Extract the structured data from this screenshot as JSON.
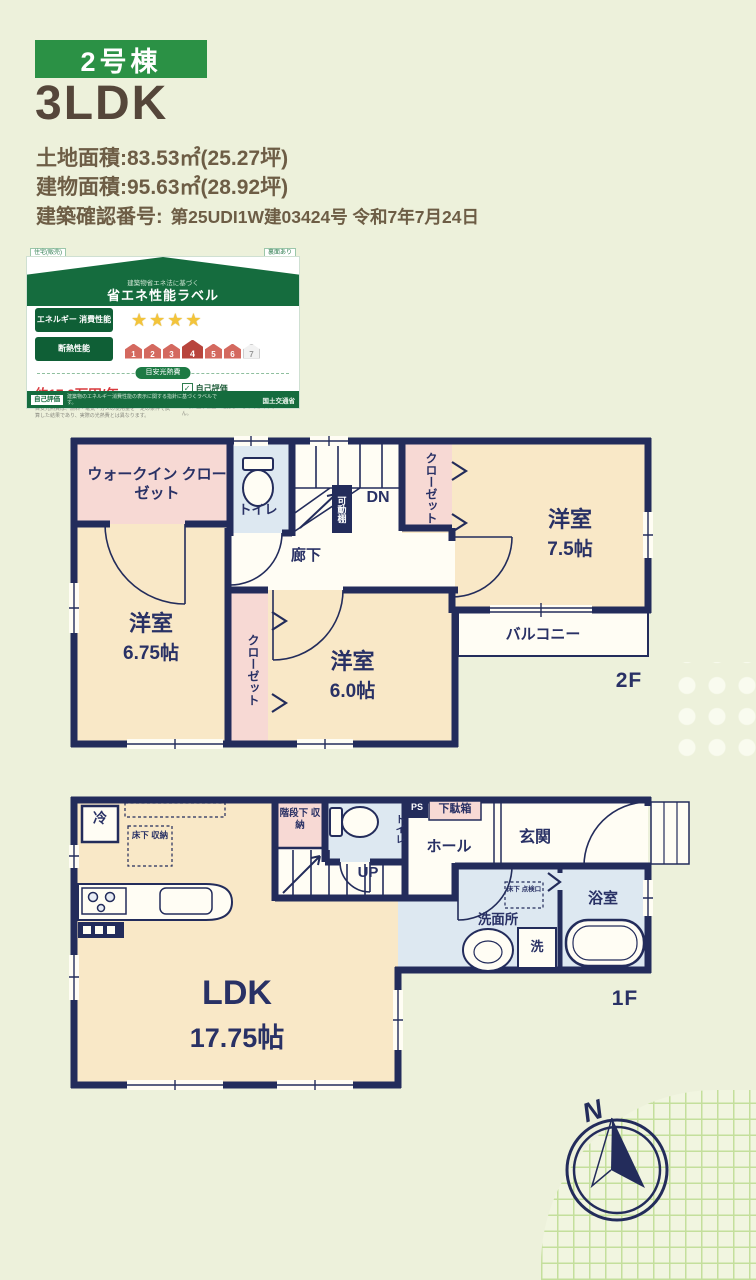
{
  "header": {
    "badge": "2号棟",
    "title": "3LDK",
    "land_area": "土地面積:83.53㎡(25.27坪)",
    "building_area": "建物面積:95.63㎡(28.92坪)",
    "confirmation_label": "建築確認番号:",
    "confirmation_value": "第25UDI1W建03424号  令和7年7月24日"
  },
  "energy_label": {
    "tag_left": "住宅(販売)",
    "tag_right": "裏面あり",
    "subtitle": "建築物省エネ法に基づく",
    "title": "省エネ性能ラベル",
    "row_energy": "エネルギー 消費性能",
    "stars": "★★★★",
    "row_insulation": "断熱性能",
    "scale": [
      "1",
      "2",
      "3",
      "4",
      "5",
      "6",
      "7"
    ],
    "cost_label": "目安光熱費",
    "cost_value": "約17.2万円/年",
    "check_mark": "✓",
    "check_label": "自己評価",
    "note_left": "目安光熱費は、燃料・電気・ガスの使用量を一定の条件で試算した結果であり、実際の光熱費とは異なります。",
    "note_right": "エネルギー消費性能や断熱性能の表示内容について、国が審査・確認したものではありません。",
    "footer_chip": "自己評価",
    "footer_note": "建築物のエネルギー消費性能の表示に関する指針に基づくラベルです。",
    "footer_right": "国土交通省"
  },
  "floor2": {
    "wic": "ウォークイン クローゼット",
    "toilet": "トイレ",
    "dn": "DN",
    "movable_shelf": "可動棚",
    "closet_right": "クローゼット",
    "room75_name": "洋室",
    "room75_size": "7.5帖",
    "hallway": "廊下",
    "room675_name": "洋室",
    "room675_size": "6.75帖",
    "closet_mid": "クローゼット",
    "room60_name": "洋室",
    "room60_size": "6.0帖",
    "balcony": "バルコニー",
    "floor_tag": "2F"
  },
  "floor1": {
    "fridge": "冷",
    "underfloor_storage": "床下 収納",
    "under_stairs_storage": "階段下 収納",
    "toilet": "トイレ",
    "up": "UP",
    "ps": "PS",
    "shoe_box": "下駄箱",
    "hall": "ホール",
    "entrance": "玄関",
    "inspection_hatch": "床下 点検口",
    "washroom": "洗面所",
    "washer": "洗",
    "bathroom": "浴室",
    "ldk_name": "LDK",
    "ldk_size": "17.75帖",
    "floor_tag": "1F"
  },
  "compass": {
    "north": "N"
  },
  "colors": {
    "background": "#edf1db",
    "wall_navy": "#232c5b",
    "room_cream": "#f9e8c7",
    "closet_pink": "#f7d9d4",
    "wet_blue": "#dde8f1",
    "badge_green": "#2b9145",
    "label_green": "#156c3e",
    "price_red": "#d93a3e",
    "star_gold": "#f3c43a"
  }
}
